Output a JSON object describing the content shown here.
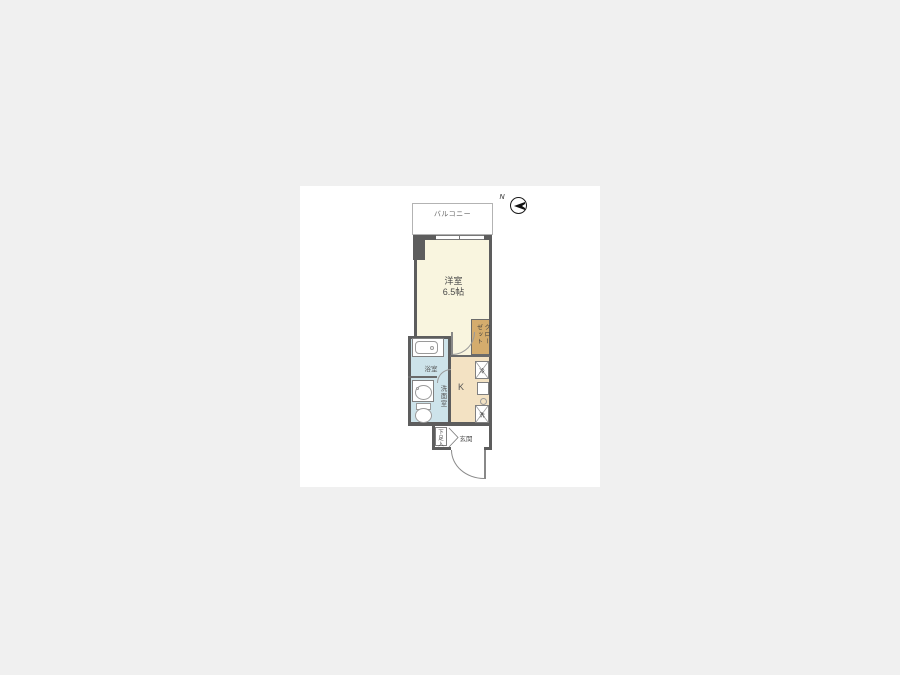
{
  "page": {
    "background_color": "#f0f0f0",
    "canvas_color": "#ffffff"
  },
  "floor_plan": {
    "compass": {
      "north_label": "N"
    },
    "balcony": {
      "label": "バルコニー"
    },
    "main_room": {
      "label": "洋室",
      "size": "6.5帖"
    },
    "closet": {
      "label": "クローゼット"
    },
    "kitchen": {
      "label": "K"
    },
    "bathroom": {
      "label": "浴室"
    },
    "washroom": {
      "label": "洗面室"
    },
    "entrance": {
      "label": "玄関"
    },
    "shoe_storage": {
      "label": "下足入"
    },
    "refrigerator_space": {
      "label": "冷"
    },
    "washer_space": {
      "label": "洗"
    },
    "colors": {
      "main_room_fill": "#f9f5df",
      "kitchen_fill": "#f3e2c3",
      "closet_fill": "#d4ac6d",
      "wet_area_fill": "#cde3ea",
      "wall_color": "#5d5d5d"
    }
  }
}
